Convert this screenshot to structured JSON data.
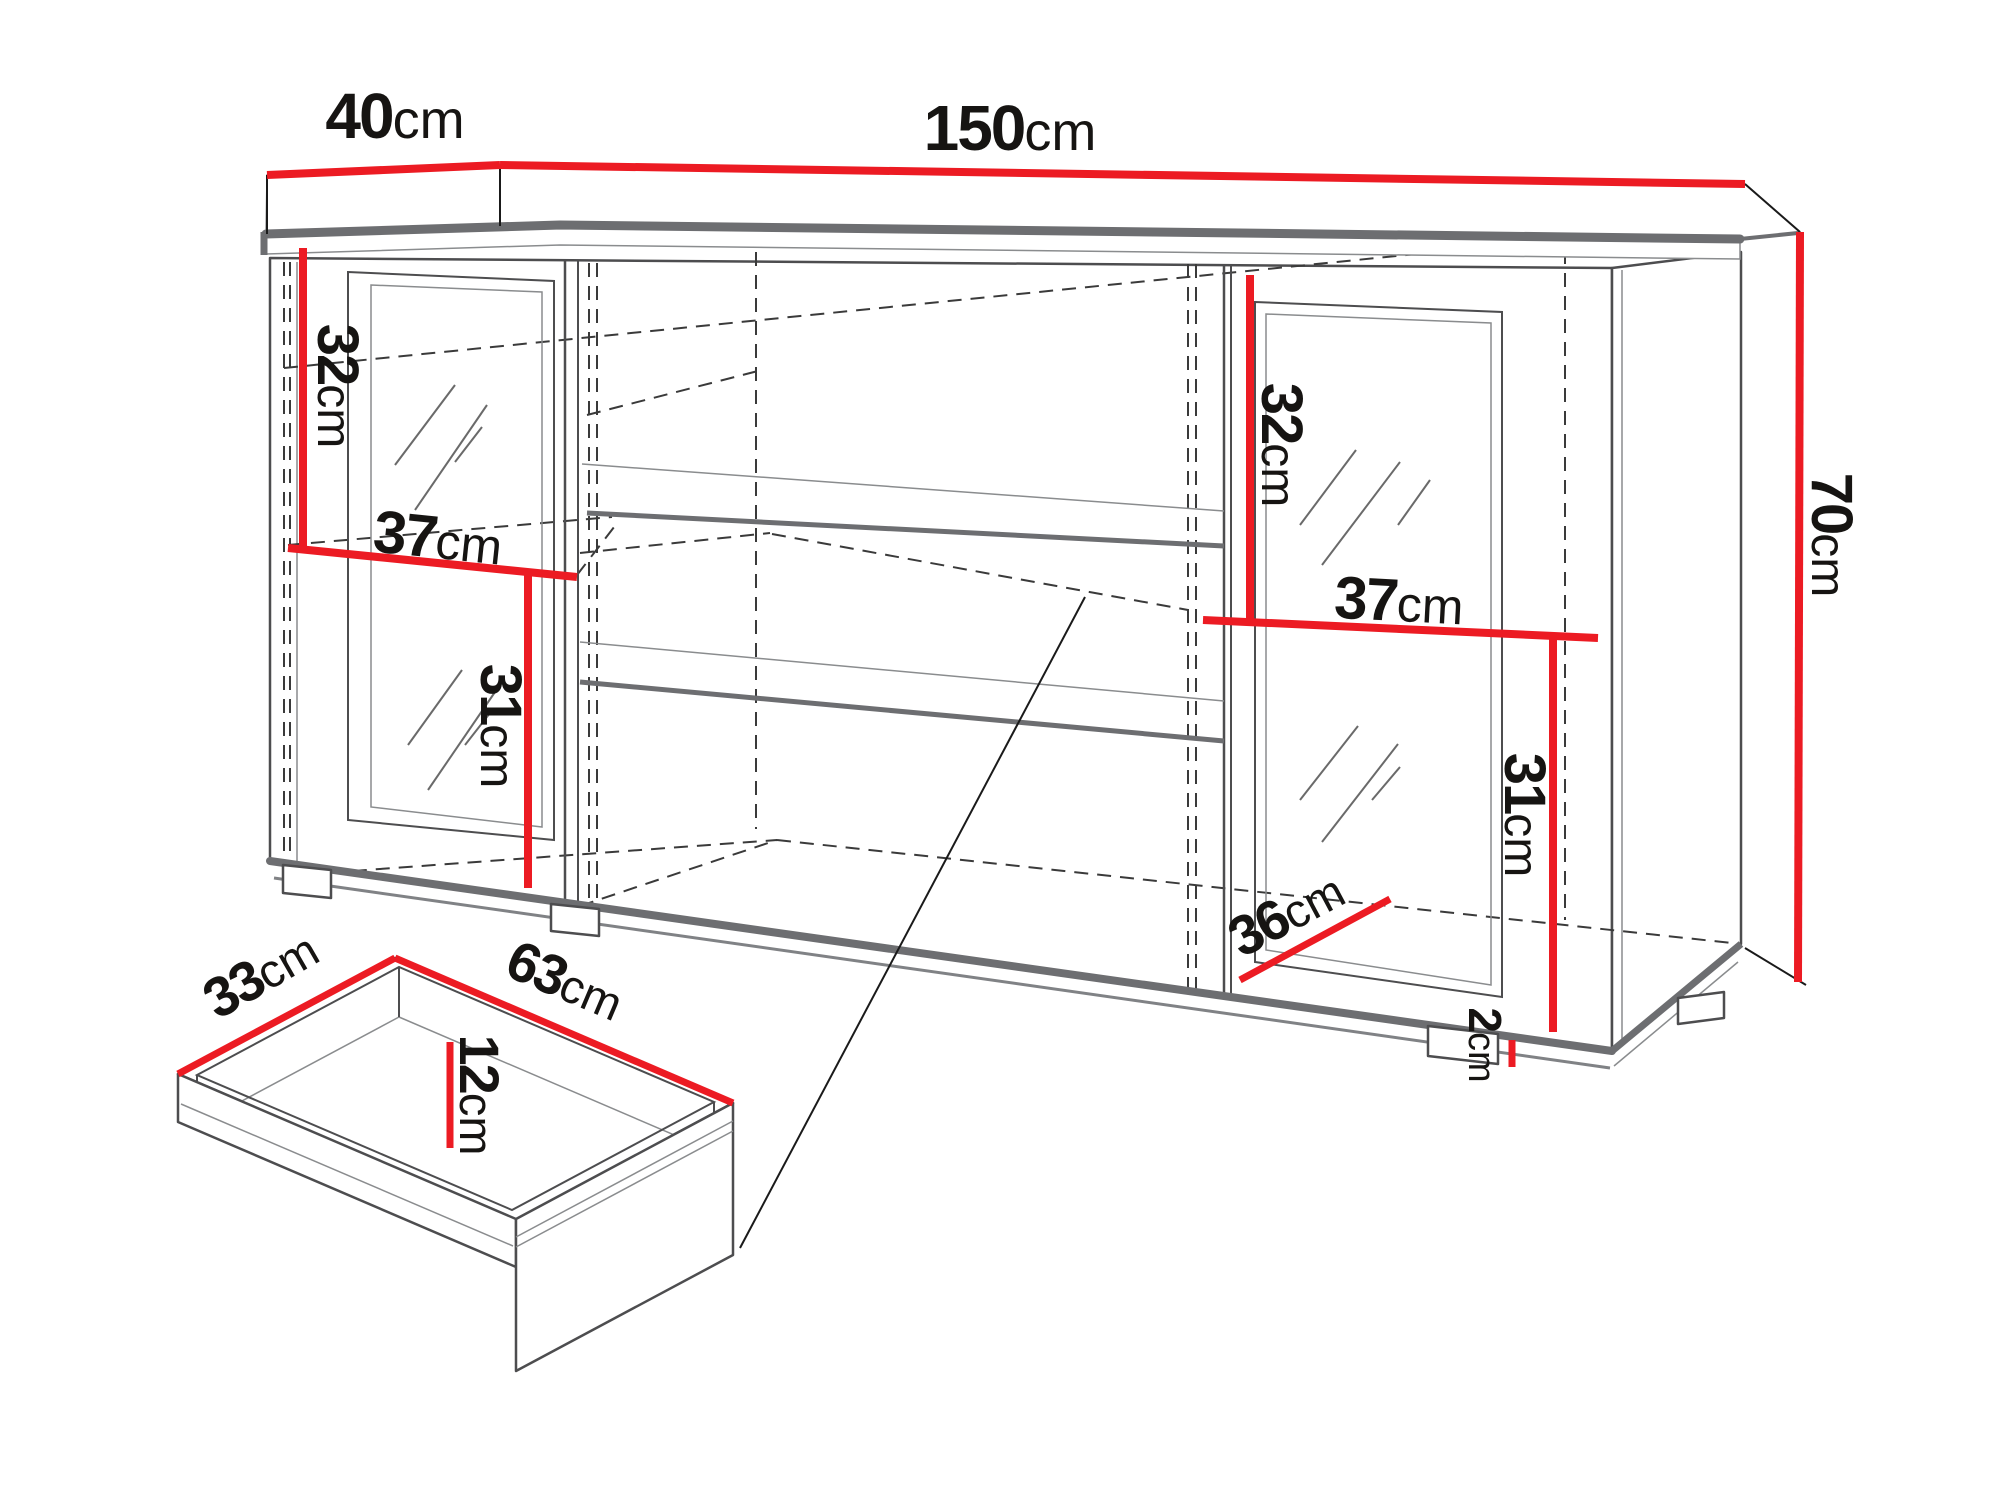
{
  "figure": {
    "kind": "furniture-dimension-diagram",
    "subject": "sideboard cabinet with two glass doors, middle shelves and inner drawer",
    "background": "#ffffff"
  },
  "colors": {
    "dimension_red": "#ec1b23",
    "outline_dark": "#4d4d4f",
    "outline_gray": "#6d6e71",
    "hidden_line": "#3a3a3a"
  },
  "labels": {
    "depth": {
      "value": "40",
      "unit": "cm"
    },
    "width": {
      "value": "150",
      "unit": "cm"
    },
    "height": {
      "value": "70",
      "unit": "cm"
    },
    "left_upper_height": {
      "value": "32",
      "unit": "cm"
    },
    "left_inner_width": {
      "value": "37",
      "unit": "cm"
    },
    "left_lower_height": {
      "value": "31",
      "unit": "cm"
    },
    "right_upper_height": {
      "value": "32",
      "unit": "cm"
    },
    "right_inner_width": {
      "value": "37",
      "unit": "cm"
    },
    "right_lower_height": {
      "value": "31",
      "unit": "cm"
    },
    "right_inner_depth": {
      "value": "36",
      "unit": "cm"
    },
    "foot_height": {
      "value": "2",
      "unit": "cm"
    },
    "drawer_depth": {
      "value": "33",
      "unit": "cm"
    },
    "drawer_width": {
      "value": "63",
      "unit": "cm"
    },
    "drawer_height": {
      "value": "12",
      "unit": "cm"
    }
  }
}
